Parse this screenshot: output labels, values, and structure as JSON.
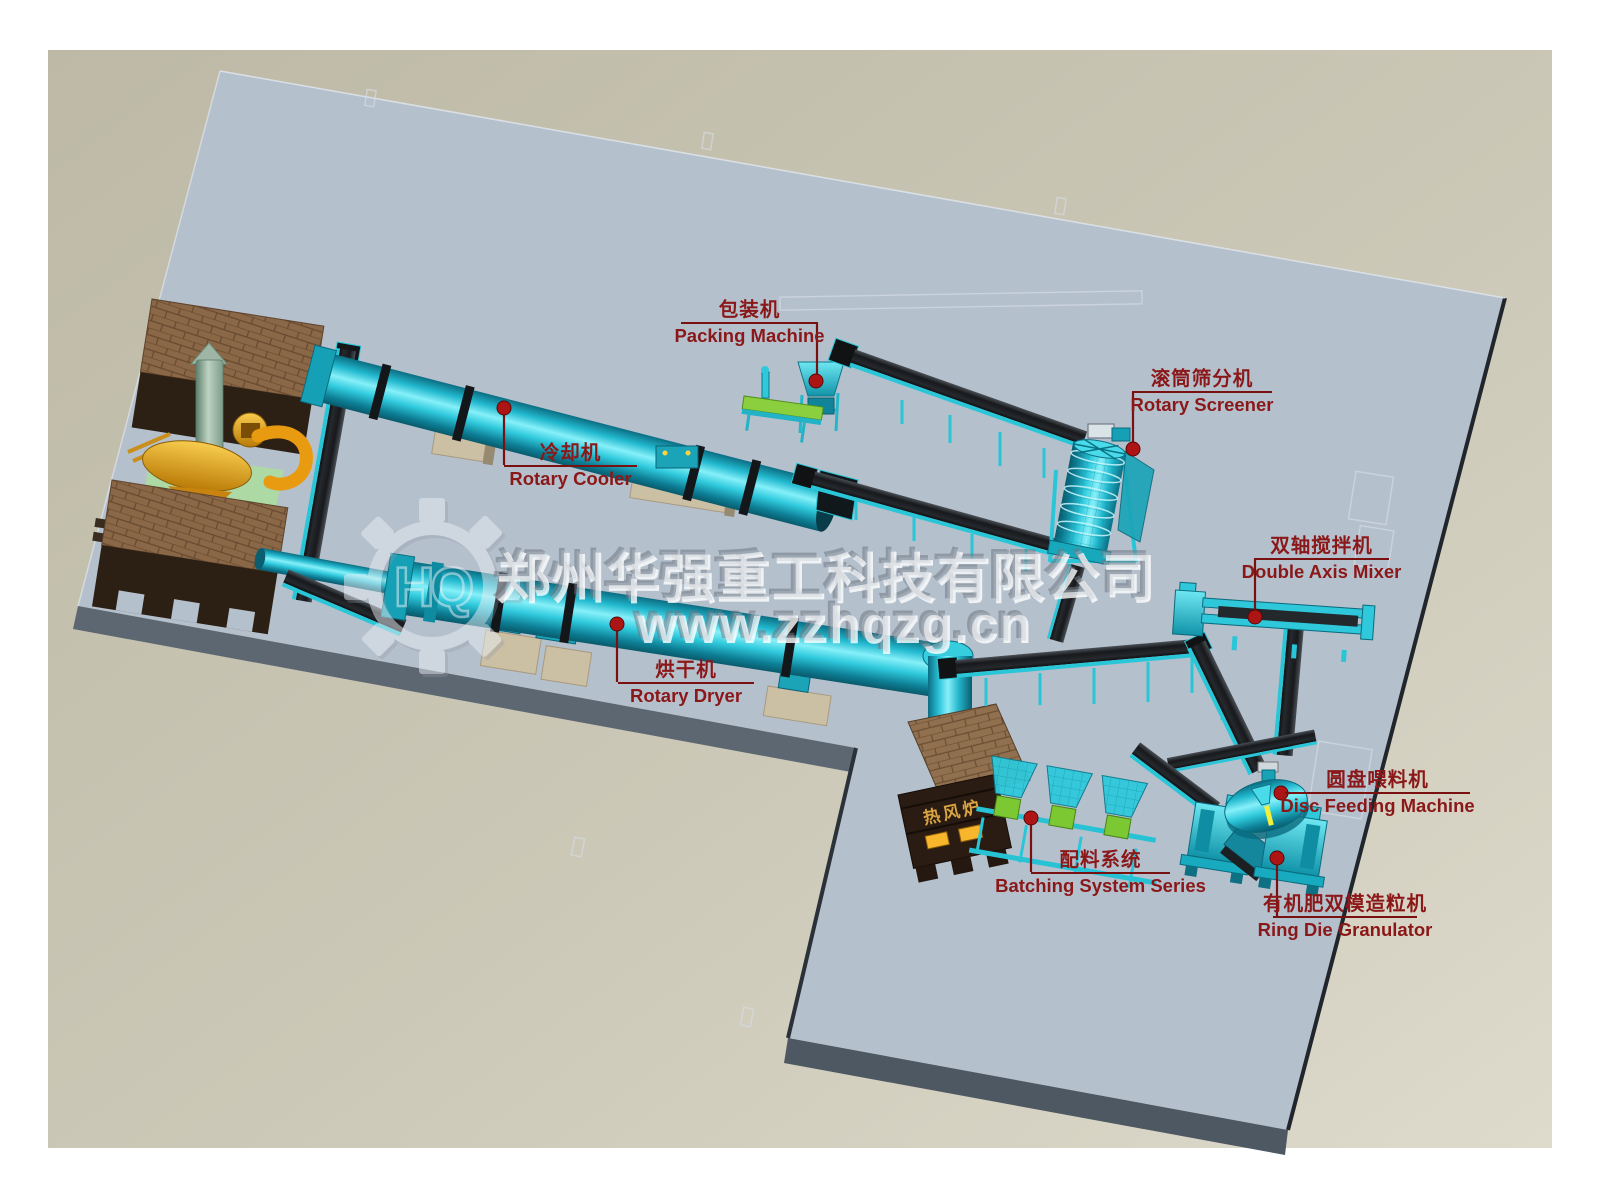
{
  "machines": [
    {
      "id": "packing-machine",
      "name_zh": "包装机",
      "name_en": "Packing Machine"
    },
    {
      "id": "rotary-screener",
      "name_zh": "滚筒筛分机",
      "name_en": "Rotary Screener"
    },
    {
      "id": "rotary-cooler",
      "name_zh": "冷却机",
      "name_en": "Rotary Cooler"
    },
    {
      "id": "double-axis-mixer",
      "name_zh": "双轴搅拌机",
      "name_en": "Double Axis Mixer"
    },
    {
      "id": "rotary-dryer",
      "name_zh": "烘干机",
      "name_en": "Rotary Dryer"
    },
    {
      "id": "disc-feeding-machine",
      "name_zh": "圆盘喂料机",
      "name_en": "Disc Feeding Machine"
    },
    {
      "id": "batching-system",
      "name_zh": "配料系统",
      "name_en": "Batching System Series"
    },
    {
      "id": "ring-die-granulator",
      "name_zh": "有机肥双模造粒机",
      "name_en": "Ring Die Granulator"
    }
  ],
  "stove": {
    "label": "热风炉"
  },
  "watermark": {
    "company": "郑州华强重工科技有限公司",
    "website": "www.zzhqzg.cn",
    "logo": "HQ"
  },
  "colors": {
    "label_red": "#8b1818",
    "leader_red": "#7a1111",
    "dot_red": "#ad1414",
    "machine_cyan": "#2fc9db",
    "slab": "#b5c0cd",
    "ground_beige": "#c8c4b2",
    "belt_dark": "#1c1f23",
    "brick_brown": "#8a6747"
  }
}
